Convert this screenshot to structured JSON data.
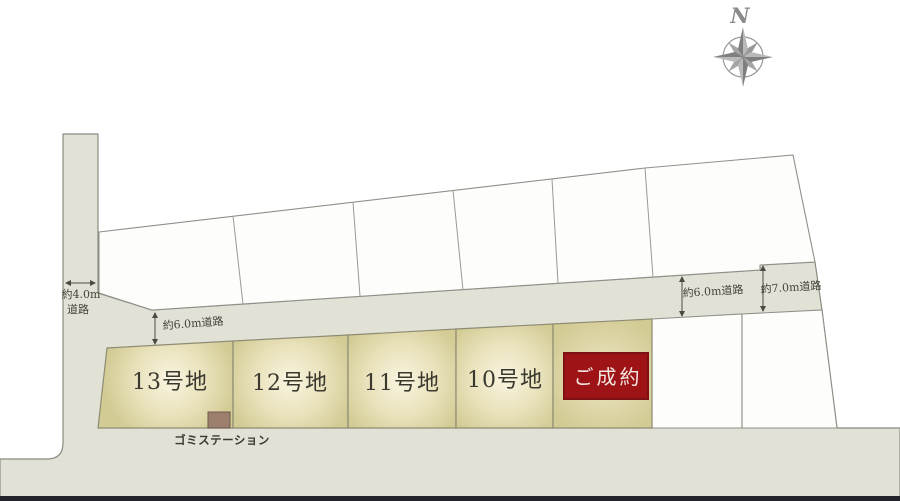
{
  "map": {
    "title": "site-plan",
    "compass_label": "N",
    "roads": {
      "left_vertical": {
        "line1": "約4.0m",
        "line2": "道路"
      },
      "main_west": {
        "label": "約6.0m道路"
      },
      "main_east": {
        "label": "約6.0m道路"
      },
      "far_east": {
        "label": "約7.0m道路"
      }
    },
    "lots_row": [
      {
        "id": "13",
        "label": "13号地",
        "status": "available"
      },
      {
        "id": "12",
        "label": "12号地",
        "status": "available"
      },
      {
        "id": "11",
        "label": "11号地",
        "status": "available"
      },
      {
        "id": "10",
        "label": "10号地",
        "status": "available"
      },
      {
        "id": "sold",
        "label": "ご成約",
        "status": "sold"
      }
    ],
    "upper_lots_count": 6,
    "garbage_station_label": "ゴミステーション"
  },
  "colors": {
    "road_fill": "#e2e1d6",
    "lot_fill": "#d3cb94",
    "lot_glow": "#f9f5e0",
    "upper_lot_fill": "#fdfdfb",
    "outline": "#8b8b80",
    "sold_red": "#9e1316",
    "sold_red_border": "#7c1013",
    "text_dark": "#3a392f",
    "compass_gray": "#999999",
    "garbage_square": "#9d7f6e",
    "bottom_bar": "#23232b"
  }
}
